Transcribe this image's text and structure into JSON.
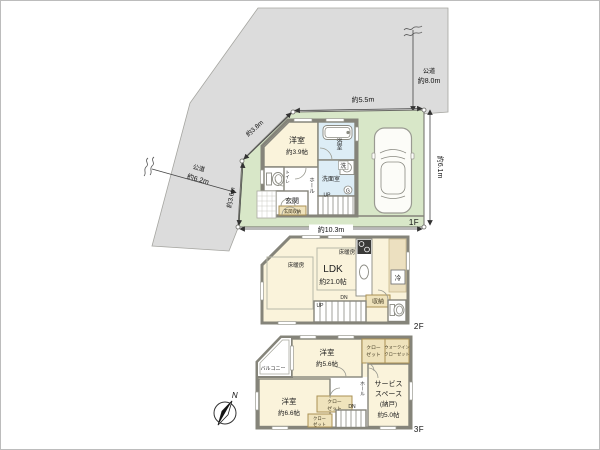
{
  "roads": {
    "right": {
      "name": "公道",
      "size": "約8.0m"
    },
    "left": {
      "name": "公道",
      "size": "約6.2m"
    }
  },
  "dimensions": {
    "top": "約5.5m",
    "upper_diagonal": "約3.8m",
    "lower_diagonal": "約3.6m",
    "right": "約6.1m",
    "bottom": "約10.3m"
  },
  "floor1": {
    "label": "1F",
    "western_room": "洋室",
    "western_room_size": "約3.9帖",
    "bathroom": "浴室",
    "laundry": "洗",
    "washroom": "洗面室",
    "toilet": "トイレ",
    "hall": "ホール",
    "entrance": "玄関",
    "entrance_storage": "玄関収納",
    "water_heater": "G",
    "stairs_up": "UP"
  },
  "floor2": {
    "label": "2F",
    "ldk": "LDK",
    "ldk_size": "約21.0帖",
    "floor_heating": "床暖房",
    "fridge": "冷",
    "storage": "収納",
    "stairs_dn": "DN",
    "stairs_up": "UP"
  },
  "floor3": {
    "label": "3F",
    "western_room_a": "洋室",
    "western_room_a_size": "約5.6帖",
    "western_room_b": "洋室",
    "western_room_b_size": "約6.6帖",
    "balcony": "バルコニー",
    "closet_line1": "クロー",
    "closet_line2": "ゼット",
    "wic_line1": "ウォークイン",
    "wic_line2": "クローゼット",
    "service_line1": "サービス",
    "service_line2": "スペース",
    "service_line3": "(納戸)",
    "service_line4": "約5.0帖",
    "hall": "ホール",
    "stairs_dn": "DN",
    "north": "N"
  },
  "colors": {
    "site_green": "#d8e7c8",
    "road_gray": "#dcdcdc",
    "room_cream": "#faf3db",
    "wet_blue": "#ddedf6",
    "closet_beige": "#efe3bc",
    "wall_gray": "#85847a"
  }
}
